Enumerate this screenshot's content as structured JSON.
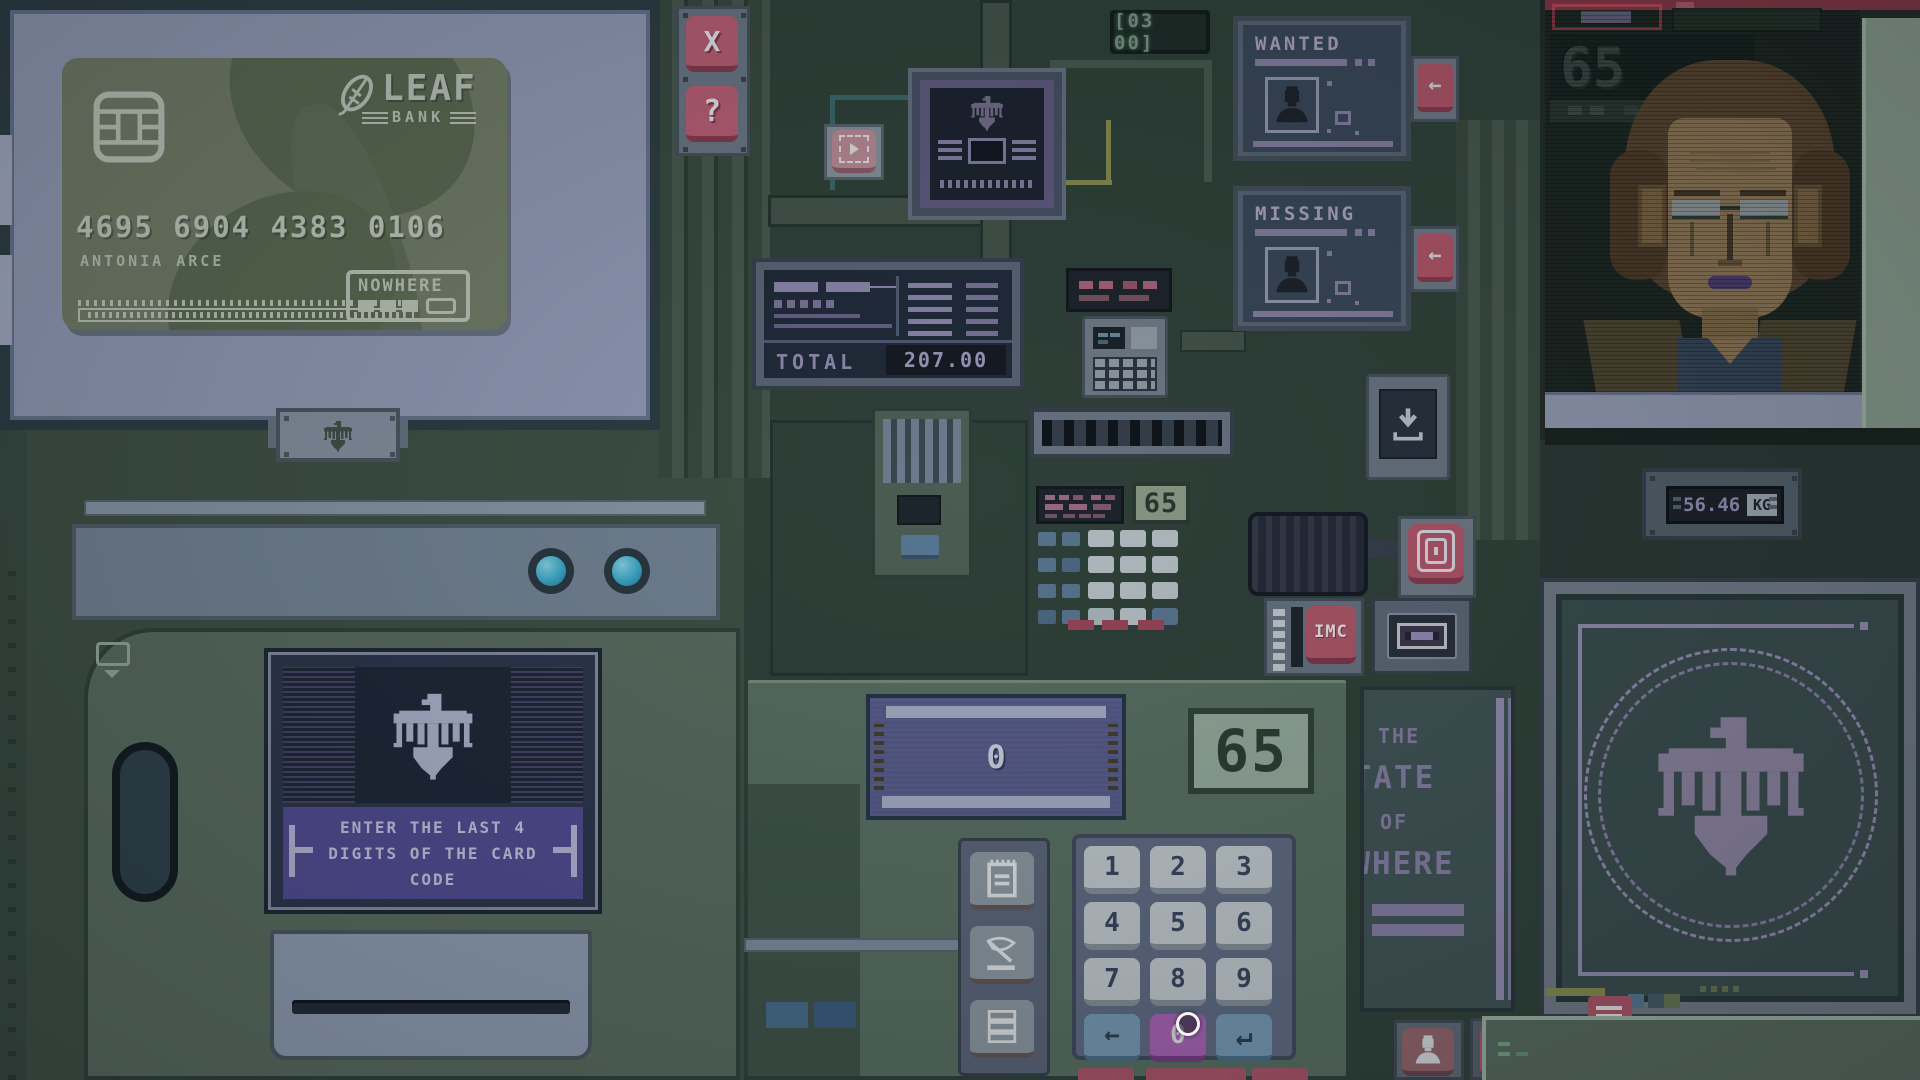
{
  "card": {
    "bank_name": "LEAF",
    "bank_tag": "BANK",
    "number": "4695 6904 4383 0106",
    "holder": "ANTONIA ARCE",
    "badge": "NOWHERE"
  },
  "monitor_buttons": {
    "close": "X",
    "help": "?"
  },
  "register": {
    "total_label": "TOTAL",
    "total_value": "207.00"
  },
  "counters": {
    "day": "[03 00]",
    "keypad_65": "65",
    "calc_65": "65",
    "portrait_65": "65",
    "amount": "0",
    "weight_value": "56.46",
    "weight_unit": "KG"
  },
  "posters": {
    "wanted_title": "WANTED",
    "missing_title": "MISSING"
  },
  "atm_screen": {
    "prompt_lines": [
      "ENTER THE LAST 4",
      "DIGITS OF THE CARD",
      "CODE"
    ]
  },
  "sign": {
    "lines": [
      "THE",
      "STATE",
      "OF",
      "NOWHERE"
    ]
  },
  "modules": {
    "imc_label": "IMC"
  },
  "keypad": {
    "digits": [
      "1",
      "2",
      "3",
      "4",
      "5",
      "6",
      "7",
      "8",
      "9"
    ],
    "zero": "0",
    "backspace": "←",
    "enter": "↵"
  },
  "colors": {
    "accent_pink": "#b85b6d",
    "accent_cyan": "#3fb5d6",
    "accent_purple": "#55509b",
    "lcd_green": "#93a68f",
    "screen_navy": "#222d3c"
  }
}
